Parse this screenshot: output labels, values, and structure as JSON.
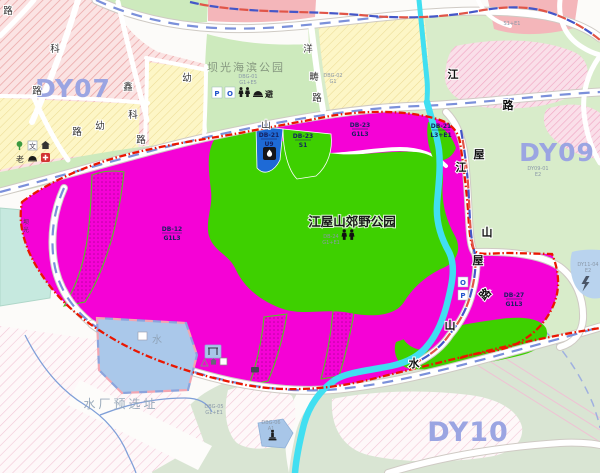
{
  "regions": {
    "dy07": "DY07",
    "dy09": "DY09",
    "dy10": "DY10"
  },
  "titles": {
    "country_park": "江屋山郊野公园",
    "seaside_park": "坝光海滨公园",
    "water_plant": "水厂预选址"
  },
  "parcels": {
    "main": {
      "code": "DB-12",
      "use": "G1L3"
    },
    "u9": {
      "code": "DB-21",
      "use": "U9"
    },
    "s1": {
      "code": "DB-23",
      "use": "S1"
    },
    "g1l3_top": {
      "code": "DB-23",
      "use": "G1L3"
    },
    "l3e1": {
      "code": "DB-21",
      "use": "L3+E1"
    },
    "east": {
      "code": "DB-27",
      "use": "G1L3"
    },
    "park_code": {
      "code": "DB-24",
      "use": "G1+E1"
    },
    "seaside_code": {
      "code": "DBG-01",
      "use": "G1+E5"
    },
    "substation": {
      "code": "DY11-04",
      "use": "E2"
    },
    "dy09_parcel": {
      "code": "DY09-01",
      "use": "E2"
    },
    "ne": {
      "code": "S1+E1"
    },
    "dbg02": {
      "code": "DBG-02",
      "use": "G1"
    },
    "dbg05": {
      "code": "DBG-05",
      "use": "G1+E1"
    },
    "dbg06": {
      "code": "DBG-06",
      "use": "A1"
    }
  },
  "road_chars": [
    {
      "t": "路"
    },
    {
      "t": "科"
    },
    {
      "t": "路"
    },
    {
      "t": "鑫"
    },
    {
      "t": "科"
    },
    {
      "t": "路"
    },
    {
      "t": "幼"
    },
    {
      "t": "路"
    },
    {
      "t": "幼"
    },
    {
      "t": "洋"
    },
    {
      "t": "畴"
    },
    {
      "t": "路"
    },
    {
      "t": "山"
    },
    {
      "t": "江"
    },
    {
      "t": "路"
    },
    {
      "t": "屋"
    },
    {
      "t": "江"
    },
    {
      "t": "山"
    },
    {
      "t": "屋"
    },
    {
      "t": "路"
    },
    {
      "t": "山"
    },
    {
      "t": "水"
    },
    {
      "t": "坝"
    },
    {
      "t": "光"
    }
  ],
  "water_labels": {
    "pond": "水"
  },
  "icon_texts": {
    "parking": "P",
    "lot": "O",
    "shelter": "避",
    "school": "文",
    "elderly": "老",
    "cross": "+",
    "parking2": "P",
    "lot2": "O"
  },
  "colors": {
    "zone_magenta": "#f502d6",
    "park_green": "#3ed000",
    "pale_green": "#cdeabd",
    "dy09_green": "#d8ecca",
    "dy10_sage": "#d9e5d3",
    "utility_blue": "#1e6ad6",
    "water_blue": "#aac8ea",
    "stream_cyan": "#41dff1",
    "boundary_red": "#ea1600",
    "road_centerline_blue": "#7b90da",
    "region_label_purple": "#9ba5e2"
  }
}
